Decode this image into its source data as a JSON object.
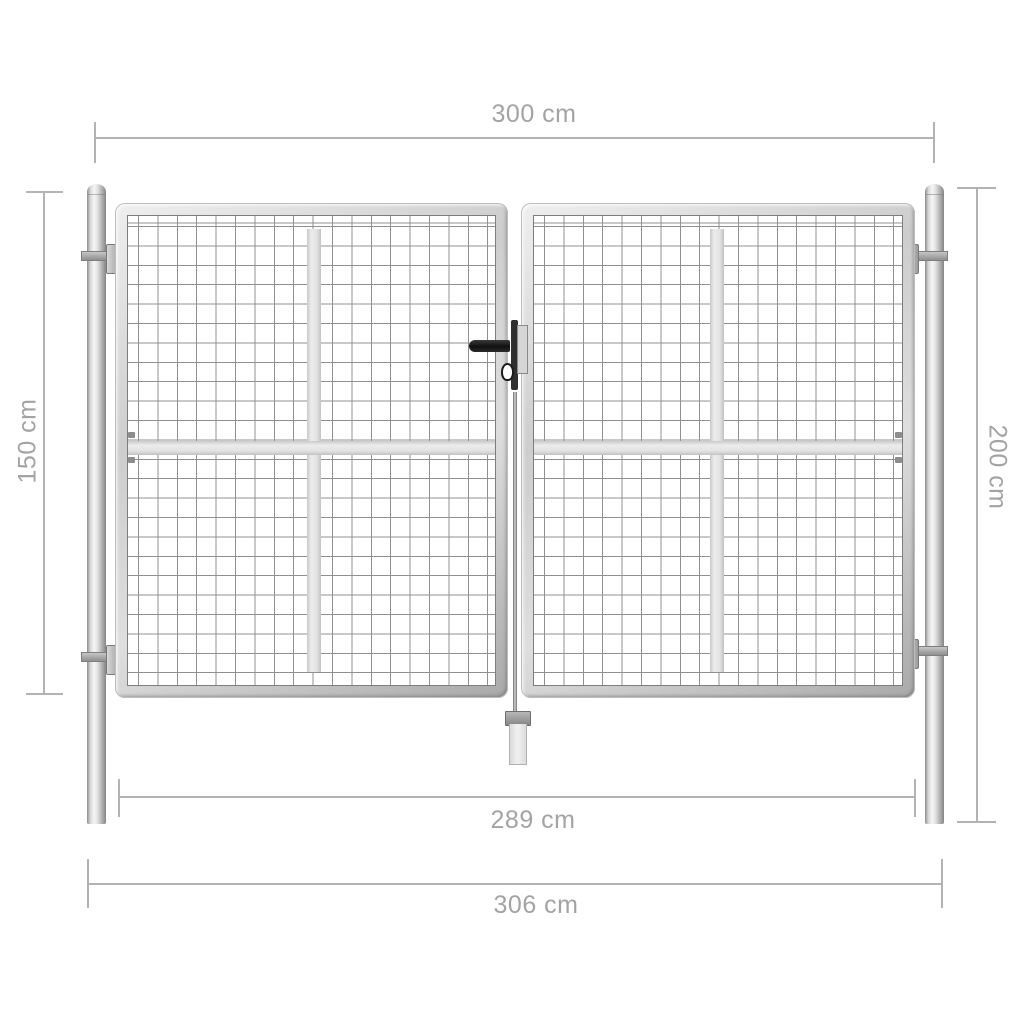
{
  "diagram": {
    "subject": "double-leaf galvanized mesh garden gate with round posts, dimension drawing",
    "labels": {
      "top_width": "300 cm",
      "gate_height": "150 cm",
      "post_height": "200 cm",
      "inner_width": "289 cm",
      "outer_width": "306 cm"
    },
    "colors": {
      "dimension_line": "#b3b3b3",
      "dimension_text": "#a3a3a3",
      "mesh_line": "#909090",
      "steel_light": "#f6f6f6",
      "steel_dark": "#858585",
      "handle_black": "#101010"
    }
  }
}
